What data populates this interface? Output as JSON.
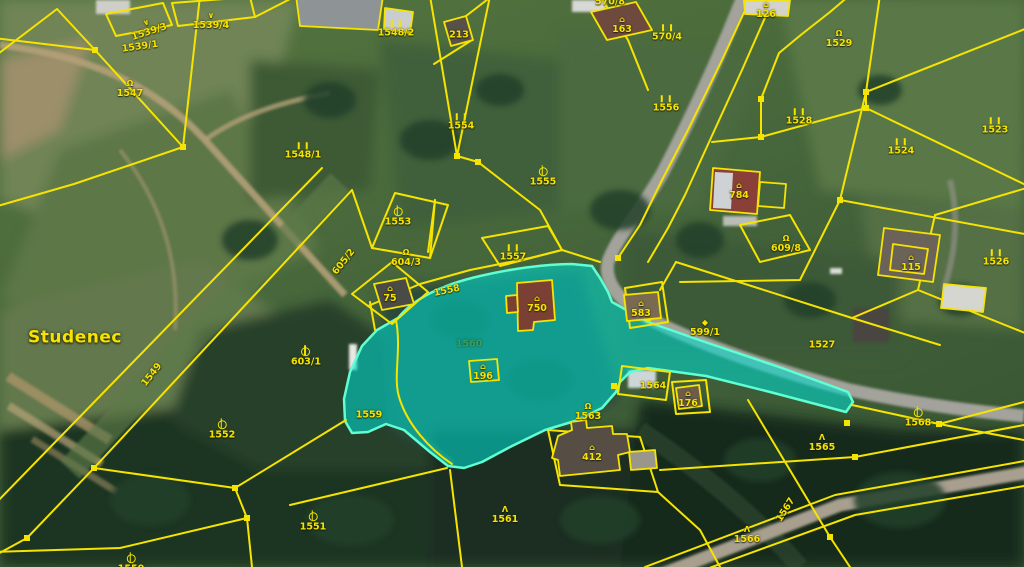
{
  "map": {
    "type": "cadastral-aerial-map",
    "place_name": "Studenec",
    "highlighted_parcel": {
      "number": "1560",
      "adjacent_highlight": "1559"
    },
    "colors": {
      "parcel_line": "#f6e400",
      "highlight_fill": "rgba(0,217,205,0.58)",
      "highlight_edge": "#5fffd2",
      "label_text": "#f6e400",
      "highlight_label_text": "#3f9e55",
      "road": "#a3a39b",
      "dirt_path": "#b3a078"
    },
    "labels": [
      {
        "text": "1539/1",
        "x": 140,
        "y": 47,
        "rot": -8,
        "icon": null,
        "kind": "parcel"
      },
      {
        "text": "1539/3",
        "x": 148,
        "y": 28,
        "rot": -18,
        "icon": "hook",
        "kind": "parcel"
      },
      {
        "text": "1539/4",
        "x": 211,
        "y": 21,
        "rot": 0,
        "icon": "hook",
        "kind": "parcel"
      },
      {
        "text": "1547",
        "x": 130,
        "y": 89,
        "rot": 0,
        "icon": "loop",
        "kind": "parcel"
      },
      {
        "text": "1548/1",
        "x": 303,
        "y": 151,
        "rot": 0,
        "icon": "bars",
        "kind": "parcel"
      },
      {
        "text": "1548/2",
        "x": 396,
        "y": 29,
        "rot": 0,
        "icon": "bars",
        "kind": "parcel"
      },
      {
        "text": "213",
        "x": 459,
        "y": 35,
        "rot": 0,
        "icon": null,
        "kind": "building"
      },
      {
        "text": "1549",
        "x": 152,
        "y": 375,
        "rot": -52,
        "icon": null,
        "kind": "line"
      },
      {
        "text": "Studenec",
        "x": 75,
        "y": 338,
        "rot": 0,
        "icon": null,
        "kind": "place"
      },
      {
        "text": "1553",
        "x": 398,
        "y": 217,
        "rot": 0,
        "icon": "circle",
        "kind": "parcel"
      },
      {
        "text": "605/2",
        "x": 344,
        "y": 262,
        "rot": -52,
        "icon": null,
        "kind": "line"
      },
      {
        "text": "604/3",
        "x": 406,
        "y": 258,
        "rot": 0,
        "icon": "loop",
        "kind": "parcel"
      },
      {
        "text": "75",
        "x": 390,
        "y": 294,
        "rot": 0,
        "icon": "house",
        "kind": "building"
      },
      {
        "text": "1557",
        "x": 513,
        "y": 253,
        "rot": 0,
        "icon": "bars",
        "kind": "parcel"
      },
      {
        "text": "1558",
        "x": 447,
        "y": 291,
        "rot": -12,
        "icon": null,
        "kind": "line"
      },
      {
        "text": "1554",
        "x": 461,
        "y": 122,
        "rot": 0,
        "icon": "bars",
        "kind": "parcel"
      },
      {
        "text": "1555",
        "x": 543,
        "y": 177,
        "rot": 0,
        "icon": "circle",
        "kind": "parcel"
      },
      {
        "text": "1556",
        "x": 666,
        "y": 104,
        "rot": 0,
        "icon": "bars",
        "kind": "parcel"
      },
      {
        "text": "163",
        "x": 622,
        "y": 25,
        "rot": 0,
        "icon": "house",
        "kind": "building"
      },
      {
        "text": "570/4",
        "x": 667,
        "y": 33,
        "rot": 0,
        "icon": "bars",
        "kind": "parcel"
      },
      {
        "text": "570/8",
        "x": 610,
        "y": 2,
        "rot": 0,
        "icon": null,
        "kind": "parcel"
      },
      {
        "text": "126",
        "x": 766,
        "y": 10,
        "rot": 0,
        "icon": "house",
        "kind": "building"
      },
      {
        "text": "1529",
        "x": 839,
        "y": 39,
        "rot": 0,
        "icon": "loop",
        "kind": "parcel"
      },
      {
        "text": "1528",
        "x": 799,
        "y": 117,
        "rot": 0,
        "icon": "bars",
        "kind": "parcel"
      },
      {
        "text": "1524",
        "x": 901,
        "y": 147,
        "rot": 0,
        "icon": "bars",
        "kind": "parcel"
      },
      {
        "text": "1523",
        "x": 995,
        "y": 126,
        "rot": 0,
        "icon": "bars",
        "kind": "parcel"
      },
      {
        "text": "784",
        "x": 739,
        "y": 191,
        "rot": 0,
        "icon": "house",
        "kind": "building"
      },
      {
        "text": "609/8",
        "x": 786,
        "y": 244,
        "rot": 0,
        "icon": "loop",
        "kind": "parcel"
      },
      {
        "text": "599/1",
        "x": 705,
        "y": 328,
        "rot": 0,
        "icon": "diamond",
        "kind": "parcel"
      },
      {
        "text": "1527",
        "x": 822,
        "y": 345,
        "rot": 0,
        "icon": null,
        "kind": "parcel"
      },
      {
        "text": "115",
        "x": 911,
        "y": 263,
        "rot": 0,
        "icon": "house",
        "kind": "building"
      },
      {
        "text": "1526",
        "x": 996,
        "y": 258,
        "rot": 0,
        "icon": "bars",
        "kind": "parcel"
      },
      {
        "text": "583",
        "x": 641,
        "y": 309,
        "rot": 0,
        "icon": "house",
        "kind": "building"
      },
      {
        "text": "750",
        "x": 537,
        "y": 304,
        "rot": 0,
        "icon": "house",
        "kind": "building"
      },
      {
        "text": "196",
        "x": 483,
        "y": 372,
        "rot": 0,
        "icon": "house",
        "kind": "building"
      },
      {
        "text": "1560",
        "x": 469,
        "y": 344,
        "rot": 0,
        "icon": null,
        "kind": "highlight"
      },
      {
        "text": "1559",
        "x": 369,
        "y": 415,
        "rot": 0,
        "icon": null,
        "kind": "parcel"
      },
      {
        "text": "1552",
        "x": 222,
        "y": 430,
        "rot": 0,
        "icon": "circle",
        "kind": "parcel"
      },
      {
        "text": "603/1",
        "x": 306,
        "y": 357,
        "rot": 0,
        "icon": "circle",
        "kind": "parcel"
      },
      {
        "text": "1551",
        "x": 313,
        "y": 522,
        "rot": 0,
        "icon": "circle",
        "kind": "parcel"
      },
      {
        "text": "1550",
        "x": 131,
        "y": 564,
        "rot": 0,
        "icon": "circle",
        "kind": "parcel"
      },
      {
        "text": "1561",
        "x": 505,
        "y": 515,
        "rot": 0,
        "icon": "conifer",
        "kind": "parcel"
      },
      {
        "text": "1563",
        "x": 588,
        "y": 412,
        "rot": 0,
        "icon": "loop",
        "kind": "parcel"
      },
      {
        "text": "412",
        "x": 592,
        "y": 453,
        "rot": 0,
        "icon": "house",
        "kind": "building"
      },
      {
        "text": "1564",
        "x": 653,
        "y": 386,
        "rot": 0,
        "icon": null,
        "kind": "parcel"
      },
      {
        "text": "176",
        "x": 688,
        "y": 399,
        "rot": 0,
        "icon": "house",
        "kind": "building"
      },
      {
        "text": "1566",
        "x": 747,
        "y": 535,
        "rot": 0,
        "icon": "conifer",
        "kind": "parcel"
      },
      {
        "text": "1567",
        "x": 786,
        "y": 510,
        "rot": -58,
        "icon": null,
        "kind": "line"
      },
      {
        "text": "1565",
        "x": 822,
        "y": 443,
        "rot": 0,
        "icon": "conifer",
        "kind": "parcel"
      },
      {
        "text": "1568",
        "x": 918,
        "y": 418,
        "rot": 0,
        "icon": "circle",
        "kind": "parcel"
      }
    ]
  }
}
